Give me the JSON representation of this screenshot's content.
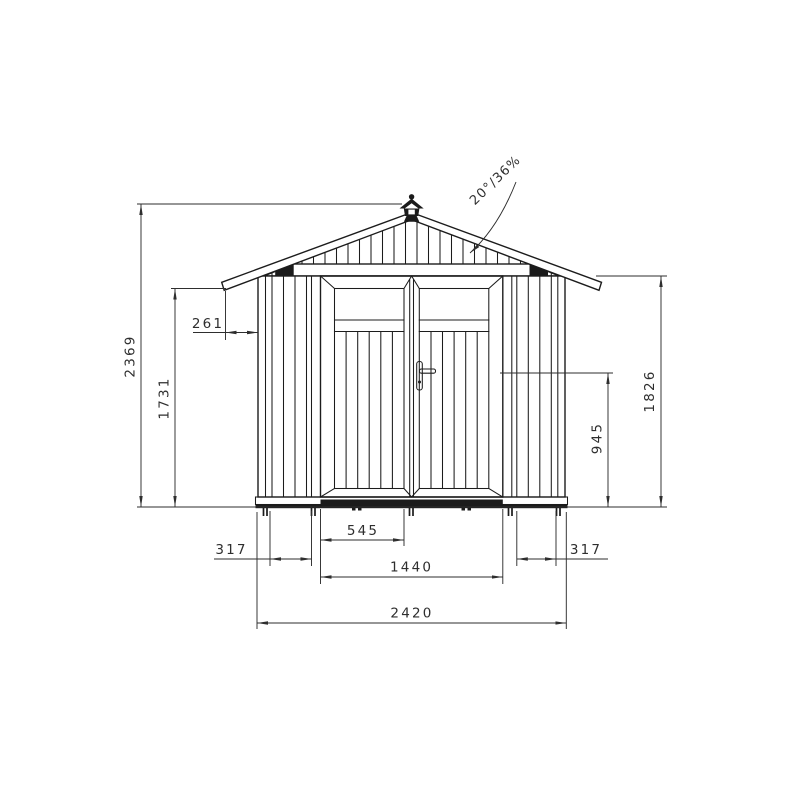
{
  "drawing": {
    "background": "#ffffff",
    "line_color": "#1c1c1c",
    "dimension_color": "#2e2e2e",
    "labels": {
      "overall_height": "2369",
      "eave_height": "1731",
      "roof_overhang": "261",
      "wall_height": "1826",
      "handle_height": "945",
      "door_leaf_width": "545",
      "door_opening_width": "1440",
      "left_panel_width": "317",
      "right_panel_width": "317",
      "overall_width": "2420",
      "roof_pitch": "20°/36%"
    }
  }
}
